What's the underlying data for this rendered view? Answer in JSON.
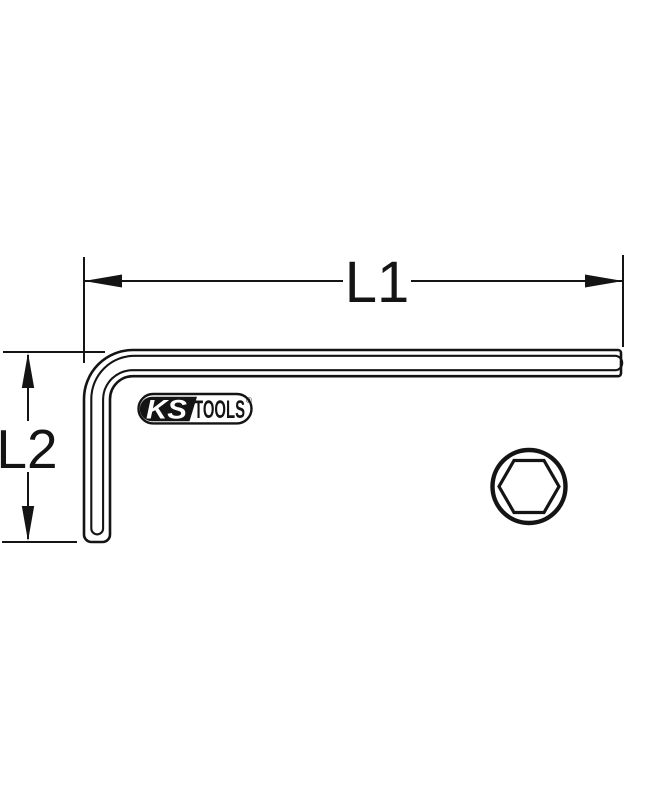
{
  "diagram": {
    "type": "technical-line-drawing",
    "subject": "L-shaped hex key (allen key) with dimension callouts and hex cross-section",
    "dimensions": {
      "l1_label": "L1",
      "l2_label": "L2"
    },
    "logo": {
      "ks": "KS",
      "tools": "TOOLS",
      "reg": "®"
    },
    "colors": {
      "line": "#141414",
      "background": "#ffffff",
      "logo_fill": "#141414"
    }
  }
}
